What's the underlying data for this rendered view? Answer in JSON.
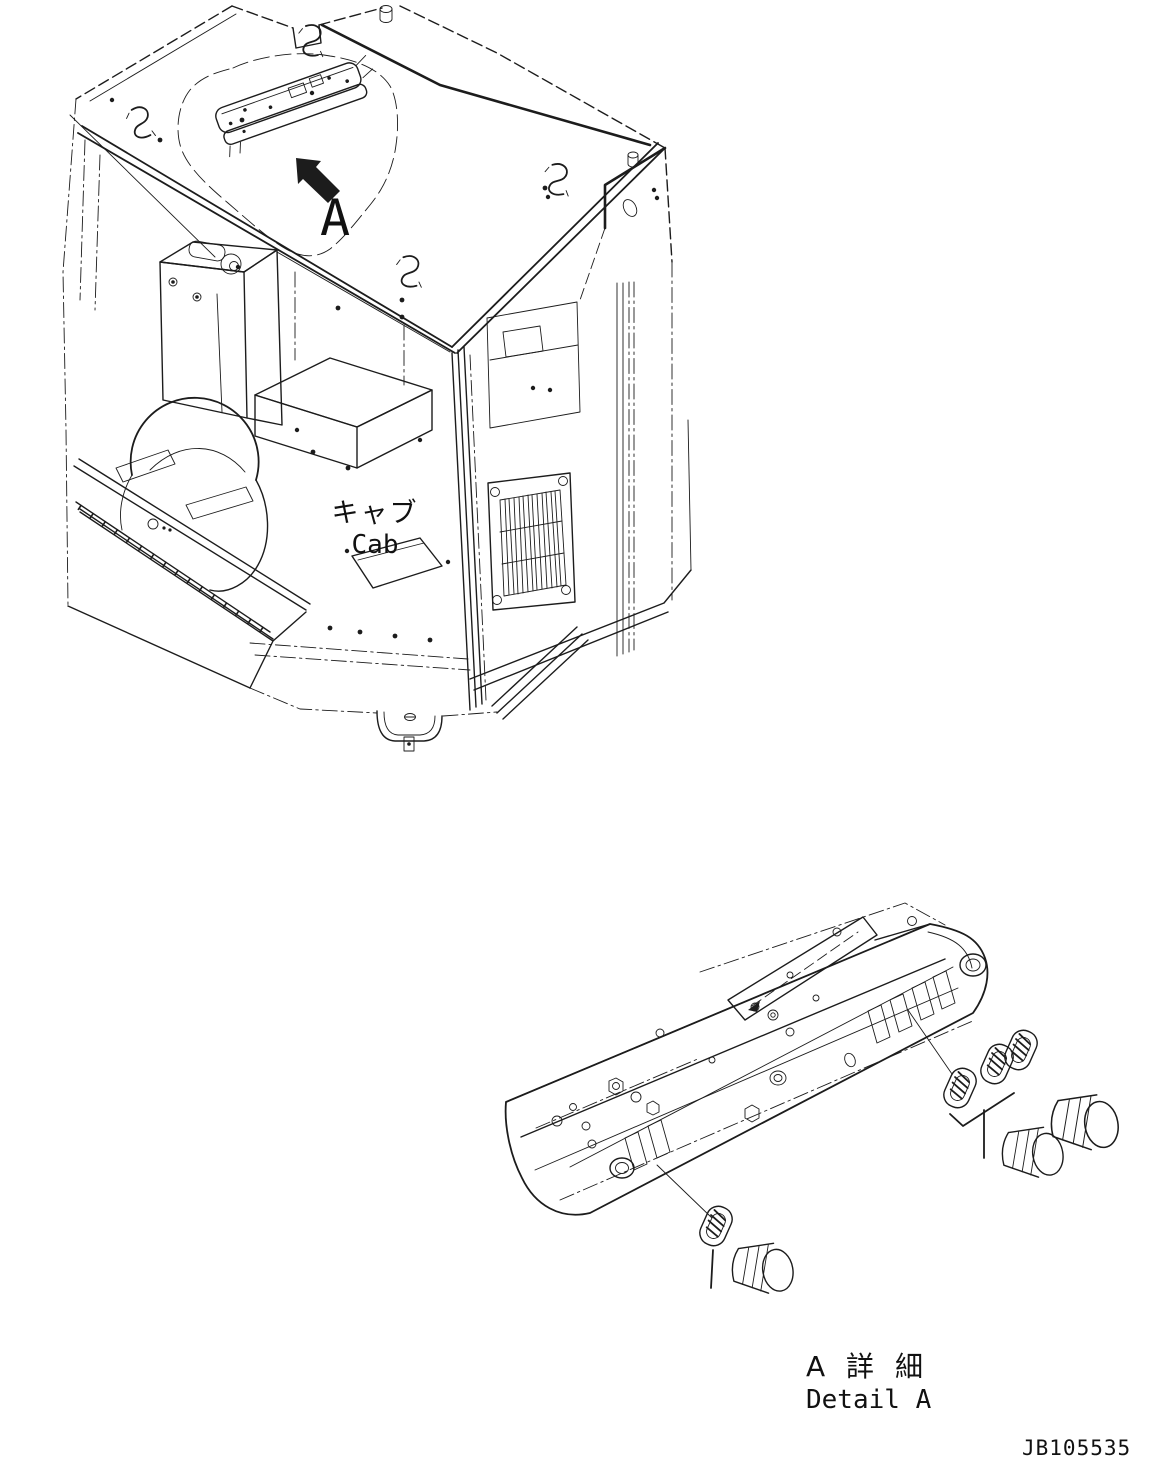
{
  "page": {
    "ink_color": "#1c1c1c",
    "background_color": "#ffffff"
  },
  "cab_view": {
    "label_jp": "キャブ",
    "label_en": "Cab",
    "callout_letter": "A"
  },
  "detail_view": {
    "title_jp": "A 詳 細",
    "title_en": "Detail A"
  },
  "footer": {
    "drawing_number": "JB105535"
  }
}
